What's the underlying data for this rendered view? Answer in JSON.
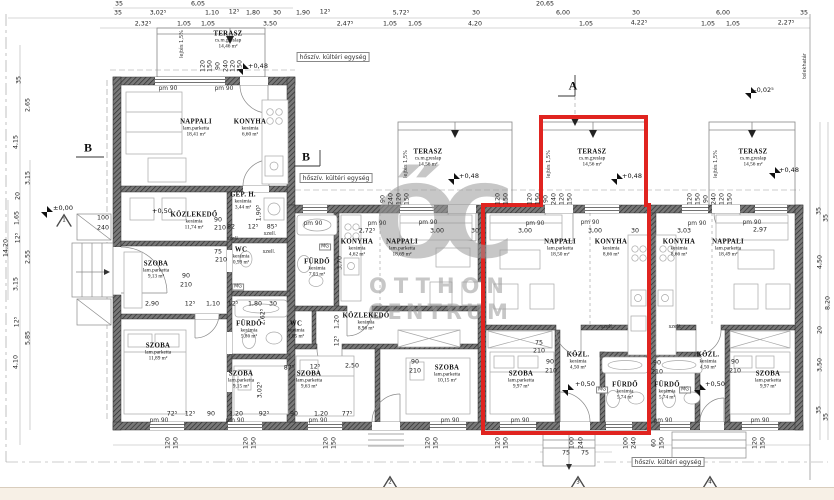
{
  "watermark": {
    "logo": "ŐC",
    "line1": "OTTHON",
    "line2": "CENTRUM"
  },
  "colors": {
    "highlight": "#e02420",
    "wall": "#787878",
    "hatch": "#2e2e2e",
    "line": "#8a8a8a",
    "watermark": "#9b9b9b",
    "footer_strip": "#f7f0e6"
  },
  "rooms": [
    {
      "name": "TERASZ",
      "material": "cs.m.greslap",
      "area": "14,46 m²",
      "x": 228,
      "y": 40
    },
    {
      "name": "NAPPALI",
      "material": "lam.parketta",
      "area": "18,41 m²",
      "x": 196,
      "y": 128
    },
    {
      "name": "KONYHA",
      "material": "kerámia",
      "area": "6,60 m²",
      "x": 250,
      "y": 128
    },
    {
      "name": "GÉP. H.",
      "material": "kerámia",
      "area": "3,44 m²",
      "x": 243,
      "y": 201
    },
    {
      "name": "KÖZLEKEDŐ",
      "material": "kerámia",
      "area": "11,74 m²",
      "x": 194,
      "y": 221
    },
    {
      "name": "SZOBA",
      "material": "lam.parketta",
      "area": "9,13 m²",
      "x": 156,
      "y": 270
    },
    {
      "name": "WC",
      "material": "kerámia",
      "area": "0,99 m²",
      "x": 241,
      "y": 256
    },
    {
      "name": "FÜRDŐ",
      "material": "kerámia",
      "area": "5,86 m²",
      "x": 249,
      "y": 330
    },
    {
      "name": "SZOBA",
      "material": "lam.parketta",
      "area": "11,89 m²",
      "x": 158,
      "y": 352
    },
    {
      "name": "SZOBA",
      "material": "lam.parketta",
      "area": "9,15 m²",
      "x": 241,
      "y": 380
    },
    {
      "name": "WC",
      "material": "kerámia",
      "area": "1,05 m²",
      "x": 296,
      "y": 330
    },
    {
      "name": "SZOBA",
      "material": "lam.parketta",
      "area": "9,63 m²",
      "x": 309,
      "y": 380
    },
    {
      "name": "FÜRDŐ",
      "material": "kerámia",
      "area": "7,03 m²",
      "x": 317,
      "y": 268
    },
    {
      "name": "KONYHA",
      "material": "kerámia",
      "area": "4,62 m²",
      "x": 357,
      "y": 248
    },
    {
      "name": "NAPPALI",
      "material": "lam.parketta",
      "area": "18,69 m²",
      "x": 402,
      "y": 248
    },
    {
      "name": "KÖZLEKEDŐ",
      "material": "kerámia",
      "area": "8,96 m²",
      "x": 366,
      "y": 322
    },
    {
      "name": "SZOBA",
      "material": "lam.parketta",
      "area": "10,15 m²",
      "x": 447,
      "y": 374
    },
    {
      "name": "TERASZ",
      "material": "cs.m.greslap",
      "area": "14,56 m²",
      "x": 428,
      "y": 158
    },
    {
      "name": "TERASZ",
      "material": "cs.m.greslap",
      "area": "14,56 m²",
      "x": 592,
      "y": 158
    },
    {
      "name": "NAPPALI",
      "material": "lam.parketta",
      "area": "18,50 m²",
      "x": 560,
      "y": 248
    },
    {
      "name": "KONYHA",
      "material": "kerámia",
      "area": "8,66 m²",
      "x": 611,
      "y": 248
    },
    {
      "name": "SZOBA",
      "material": "lam.parketta",
      "area": "9,97 m²",
      "x": 521,
      "y": 380
    },
    {
      "name": "KÖZL.",
      "material": "kerámia",
      "area": "4,50 m²",
      "x": 578,
      "y": 361
    },
    {
      "name": "FÜRDŐ",
      "material": "kerámia",
      "area": "5,74 m²",
      "x": 625,
      "y": 391
    },
    {
      "name": "FÜRDŐ",
      "material": "kerámia",
      "area": "5,74 m²",
      "x": 667,
      "y": 391
    },
    {
      "name": "KÖZL.",
      "material": "kerámia",
      "area": "4,50 m²",
      "x": 708,
      "y": 361
    },
    {
      "name": "KONYHA",
      "material": "kerámia",
      "area": "8,66 m²",
      "x": 679,
      "y": 248
    },
    {
      "name": "NAPPALI",
      "material": "lam.parketta",
      "area": "18,49 m²",
      "x": 728,
      "y": 248
    },
    {
      "name": "SZOBA",
      "material": "lam.parketta",
      "area": "9,97 m²",
      "x": 768,
      "y": 380
    },
    {
      "name": "TERASZ",
      "material": "cs.m.greslap",
      "area": "14,56 m²",
      "x": 753,
      "y": 158
    }
  ],
  "elevations": [
    {
      "t": "±0,00",
      "x": 63,
      "y": 208
    },
    {
      "t": "+0,50",
      "x": 162,
      "y": 211
    },
    {
      "t": "+0,48",
      "x": 258,
      "y": 66
    },
    {
      "t": "+0,48",
      "x": 469,
      "y": 176
    },
    {
      "t": "+0,48",
      "x": 632,
      "y": 176
    },
    {
      "t": "+0,48",
      "x": 789,
      "y": 170
    },
    {
      "t": "-0,02⁵",
      "x": 764,
      "y": 90
    },
    {
      "t": "+0,50",
      "x": 585,
      "y": 384
    },
    {
      "t": "+0,50",
      "x": 715,
      "y": 384
    },
    {
      "t": "±0,00",
      "x": 598,
      "y": 491
    }
  ],
  "section_letters": [
    {
      "t": "A",
      "x": 573,
      "y": 86
    },
    {
      "t": "B",
      "x": 88,
      "y": 148
    },
    {
      "t": "B",
      "x": 306,
      "y": 157
    }
  ],
  "node_markers": [
    {
      "n": "1",
      "x": 64,
      "y": 220
    },
    {
      "n": "2",
      "x": 390,
      "y": 482
    },
    {
      "n": "3",
      "x": 578,
      "y": 482
    },
    {
      "n": "4",
      "x": 710,
      "y": 482
    }
  ],
  "notes": [
    {
      "t": "hőszív. kültéri egység",
      "x": 333,
      "y": 57
    },
    {
      "t": "hőszív. kültéri egység",
      "x": 336,
      "y": 178
    },
    {
      "t": "hőszív. kültéri egység",
      "x": 668,
      "y": 462
    }
  ],
  "boundary_label": {
    "t": "telekhatár",
    "x": 805,
    "y": 66
  },
  "lintel_labels": {
    "text": "pm 90",
    "pos": [
      [
        168,
        89
      ],
      [
        224,
        89
      ],
      [
        313,
        224
      ],
      [
        377,
        224
      ],
      [
        428,
        223
      ],
      [
        535,
        224
      ],
      [
        590,
        223
      ],
      [
        697,
        224
      ],
      [
        752,
        223
      ],
      [
        159,
        421
      ],
      [
        235,
        421
      ],
      [
        318,
        421
      ],
      [
        450,
        421
      ],
      [
        520,
        421
      ],
      [
        663,
        421
      ],
      [
        760,
        421
      ]
    ]
  },
  "vent_labels": {
    "text": "szell.",
    "pos": [
      [
        233,
        239
      ],
      [
        270,
        234
      ],
      [
        269,
        252
      ],
      [
        607,
        327
      ],
      [
        675,
        327
      ]
    ]
  },
  "washer_labels": {
    "text": "MG",
    "pos": [
      [
        325,
        247
      ],
      [
        238,
        287
      ],
      [
        602,
        390
      ],
      [
        685,
        390
      ]
    ]
  },
  "slope_labels": {
    "text": "lejtés 1,5%",
    "pos": [
      [
        182,
        44
      ],
      [
        406,
        164
      ],
      [
        549,
        164
      ],
      [
        716,
        164
      ]
    ]
  },
  "dims_h": [
    {
      "t": "35",
      "x": 119,
      "y": 4
    },
    {
      "t": "6,05",
      "x": 198,
      "y": 4
    },
    {
      "t": "20,65",
      "x": 545,
      "y": 4
    },
    {
      "t": "35",
      "x": 118,
      "y": 13
    },
    {
      "t": "3,02⁵",
      "x": 158,
      "y": 13
    },
    {
      "t": "1,10",
      "x": 212,
      "y": 13
    },
    {
      "t": "12⁵",
      "x": 234,
      "y": 12
    },
    {
      "t": "1,80",
      "x": 253,
      "y": 13
    },
    {
      "t": "30",
      "x": 277,
      "y": 13
    },
    {
      "t": "1,90",
      "x": 303,
      "y": 13
    },
    {
      "t": "12⁵",
      "x": 325,
      "y": 12
    },
    {
      "t": "5,72⁵",
      "x": 401,
      "y": 13
    },
    {
      "t": "30",
      "x": 476,
      "y": 13
    },
    {
      "t": "6,00",
      "x": 563,
      "y": 13
    },
    {
      "t": "30",
      "x": 636,
      "y": 13
    },
    {
      "t": "6,00",
      "x": 723,
      "y": 13
    },
    {
      "t": "35",
      "x": 804,
      "y": 13
    },
    {
      "t": "2,32⁵",
      "x": 143,
      "y": 24
    },
    {
      "t": "1,05",
      "x": 184,
      "y": 24
    },
    {
      "t": "1,05",
      "x": 208,
      "y": 24
    },
    {
      "t": "3,50",
      "x": 270,
      "y": 24
    },
    {
      "t": "2,47⁵",
      "x": 345,
      "y": 24
    },
    {
      "t": "1,05",
      "x": 390,
      "y": 24
    },
    {
      "t": "1,05",
      "x": 415,
      "y": 24
    },
    {
      "t": "4,20",
      "x": 475,
      "y": 24
    },
    {
      "t": "1,05",
      "x": 586,
      "y": 24
    },
    {
      "t": "4,22⁵",
      "x": 639,
      "y": 23
    },
    {
      "t": "1,05",
      "x": 708,
      "y": 24
    },
    {
      "t": "1,05",
      "x": 733,
      "y": 24
    },
    {
      "t": "2,27⁵",
      "x": 786,
      "y": 23
    },
    {
      "t": "2,72⁵",
      "x": 367,
      "y": 231
    },
    {
      "t": "3,00",
      "x": 437,
      "y": 231
    },
    {
      "t": "30",
      "x": 475,
      "y": 231
    },
    {
      "t": "3,00",
      "x": 525,
      "y": 231
    },
    {
      "t": "3,00",
      "x": 595,
      "y": 231
    },
    {
      "t": "30",
      "x": 635,
      "y": 231
    },
    {
      "t": "3,03",
      "x": 684,
      "y": 231
    },
    {
      "t": "2,97",
      "x": 760,
      "y": 230
    },
    {
      "t": "2,90",
      "x": 152,
      "y": 304
    },
    {
      "t": "12⁵",
      "x": 190,
      "y": 304
    },
    {
      "t": "1,10",
      "x": 213,
      "y": 304
    },
    {
      "t": "12⁵",
      "x": 233,
      "y": 304
    },
    {
      "t": "1,80",
      "x": 255,
      "y": 304
    },
    {
      "t": "30",
      "x": 273,
      "y": 304
    },
    {
      "t": "82",
      "x": 231,
      "y": 227
    },
    {
      "t": "12⁵",
      "x": 253,
      "y": 227
    },
    {
      "t": "85⁵",
      "x": 272,
      "y": 227
    },
    {
      "t": "2,50",
      "x": 352,
      "y": 366
    },
    {
      "t": "87⁵",
      "x": 289,
      "y": 368
    },
    {
      "t": "12⁵",
      "x": 315,
      "y": 367
    },
    {
      "t": "72⁵",
      "x": 172,
      "y": 414
    },
    {
      "t": "12⁵",
      "x": 190,
      "y": 414
    },
    {
      "t": "90",
      "x": 211,
      "y": 414
    },
    {
      "t": "1,20",
      "x": 236,
      "y": 414
    },
    {
      "t": "92⁵",
      "x": 264,
      "y": 414
    },
    {
      "t": "90",
      "x": 294,
      "y": 414
    },
    {
      "t": "1,20",
      "x": 321,
      "y": 414
    },
    {
      "t": "77⁵",
      "x": 347,
      "y": 414
    },
    {
      "t": "90",
      "x": 186,
      "y": 276
    },
    {
      "t": "210",
      "x": 186,
      "y": 285
    },
    {
      "t": "90",
      "x": 218,
      "y": 220
    },
    {
      "t": "210",
      "x": 220,
      "y": 228
    },
    {
      "t": "90",
      "x": 415,
      "y": 362
    },
    {
      "t": "210",
      "x": 415,
      "y": 371
    },
    {
      "t": "90",
      "x": 550,
      "y": 362
    },
    {
      "t": "210",
      "x": 551,
      "y": 371
    },
    {
      "t": "90",
      "x": 657,
      "y": 363
    },
    {
      "t": "210",
      "x": 657,
      "y": 372
    },
    {
      "t": "90",
      "x": 735,
      "y": 362
    },
    {
      "t": "210",
      "x": 735,
      "y": 371
    },
    {
      "t": "75",
      "x": 218,
      "y": 252
    },
    {
      "t": "210",
      "x": 221,
      "y": 260
    },
    {
      "t": "75",
      "x": 539,
      "y": 343
    },
    {
      "t": "210",
      "x": 539,
      "y": 351
    },
    {
      "t": "100",
      "x": 103,
      "y": 218
    },
    {
      "t": "240",
      "x": 103,
      "y": 228
    },
    {
      "t": "75",
      "x": 566,
      "y": 453
    },
    {
      "t": "75",
      "x": 585,
      "y": 453
    }
  ],
  "dims_v": [
    {
      "t": "35",
      "x": 19,
      "y": 80
    },
    {
      "t": "2,65",
      "x": 28,
      "y": 105
    },
    {
      "t": "4,15",
      "x": 16,
      "y": 142
    },
    {
      "t": "3,15",
      "x": 28,
      "y": 178
    },
    {
      "t": "20",
      "x": 18,
      "y": 196
    },
    {
      "t": "1,65",
      "x": 17,
      "y": 218
    },
    {
      "t": "12⁵",
      "x": 18,
      "y": 238
    },
    {
      "t": "14,20",
      "x": 6,
      "y": 248
    },
    {
      "t": "2,55",
      "x": 28,
      "y": 257
    },
    {
      "t": "3,15",
      "x": 16,
      "y": 284
    },
    {
      "t": "12⁵",
      "x": 17,
      "y": 322
    },
    {
      "t": "5,85",
      "x": 28,
      "y": 338
    },
    {
      "t": "4,10",
      "x": 16,
      "y": 362
    },
    {
      "t": "35",
      "x": 819,
      "y": 211
    },
    {
      "t": "35",
      "x": 826,
      "y": 218
    },
    {
      "t": "4,50",
      "x": 820,
      "y": 262
    },
    {
      "t": "8,20",
      "x": 828,
      "y": 303
    },
    {
      "t": "20",
      "x": 820,
      "y": 330
    },
    {
      "t": "3,50",
      "x": 820,
      "y": 365
    },
    {
      "t": "35",
      "x": 819,
      "y": 410
    },
    {
      "t": "35",
      "x": 826,
      "y": 417
    },
    {
      "t": "120",
      "x": 203,
      "y": 66
    },
    {
      "t": "150",
      "x": 210,
      "y": 66
    },
    {
      "t": "90",
      "x": 218,
      "y": 66
    },
    {
      "t": "240",
      "x": 226,
      "y": 66
    },
    {
      "t": "120",
      "x": 233,
      "y": 66
    },
    {
      "t": "150",
      "x": 240,
      "y": 66
    },
    {
      "t": "90",
      "x": 383,
      "y": 199
    },
    {
      "t": "240",
      "x": 391,
      "y": 199
    },
    {
      "t": "120",
      "x": 399,
      "y": 199
    },
    {
      "t": "150",
      "x": 407,
      "y": 199
    },
    {
      "t": "120",
      "x": 498,
      "y": 199
    },
    {
      "t": "150",
      "x": 506,
      "y": 199
    },
    {
      "t": "120",
      "x": 530,
      "y": 199
    },
    {
      "t": "150",
      "x": 538,
      "y": 199
    },
    {
      "t": "90",
      "x": 546,
      "y": 199
    },
    {
      "t": "240",
      "x": 554,
      "y": 199
    },
    {
      "t": "120",
      "x": 562,
      "y": 199
    },
    {
      "t": "150",
      "x": 570,
      "y": 199
    },
    {
      "t": "120",
      "x": 690,
      "y": 199
    },
    {
      "t": "150",
      "x": 698,
      "y": 199
    },
    {
      "t": "90",
      "x": 706,
      "y": 199
    },
    {
      "t": "240",
      "x": 714,
      "y": 199
    },
    {
      "t": "120",
      "x": 722,
      "y": 199
    },
    {
      "t": "150",
      "x": 730,
      "y": 199
    },
    {
      "t": "120",
      "x": 168,
      "y": 443
    },
    {
      "t": "150",
      "x": 176,
      "y": 443
    },
    {
      "t": "120",
      "x": 246,
      "y": 443
    },
    {
      "t": "150",
      "x": 254,
      "y": 443
    },
    {
      "t": "120",
      "x": 326,
      "y": 443
    },
    {
      "t": "150",
      "x": 334,
      "y": 443
    },
    {
      "t": "120",
      "x": 428,
      "y": 443
    },
    {
      "t": "150",
      "x": 436,
      "y": 443
    },
    {
      "t": "120",
      "x": 498,
      "y": 443
    },
    {
      "t": "150",
      "x": 506,
      "y": 443
    },
    {
      "t": "100",
      "x": 572,
      "y": 443
    },
    {
      "t": "240",
      "x": 581,
      "y": 443
    },
    {
      "t": "100",
      "x": 626,
      "y": 443
    },
    {
      "t": "240",
      "x": 634,
      "y": 443
    },
    {
      "t": "60",
      "x": 654,
      "y": 443
    },
    {
      "t": "150",
      "x": 662,
      "y": 443
    },
    {
      "t": "120",
      "x": 755,
      "y": 443
    },
    {
      "t": "150",
      "x": 763,
      "y": 443
    },
    {
      "t": "3,70",
      "x": 340,
      "y": 263
    },
    {
      "t": "1,20",
      "x": 337,
      "y": 322
    },
    {
      "t": "12⁵",
      "x": 337,
      "y": 341
    },
    {
      "t": "2,62⁵",
      "x": 263,
      "y": 317
    },
    {
      "t": "3,02⁵",
      "x": 260,
      "y": 390
    },
    {
      "t": "1,90⁵",
      "x": 259,
      "y": 213
    }
  ]
}
